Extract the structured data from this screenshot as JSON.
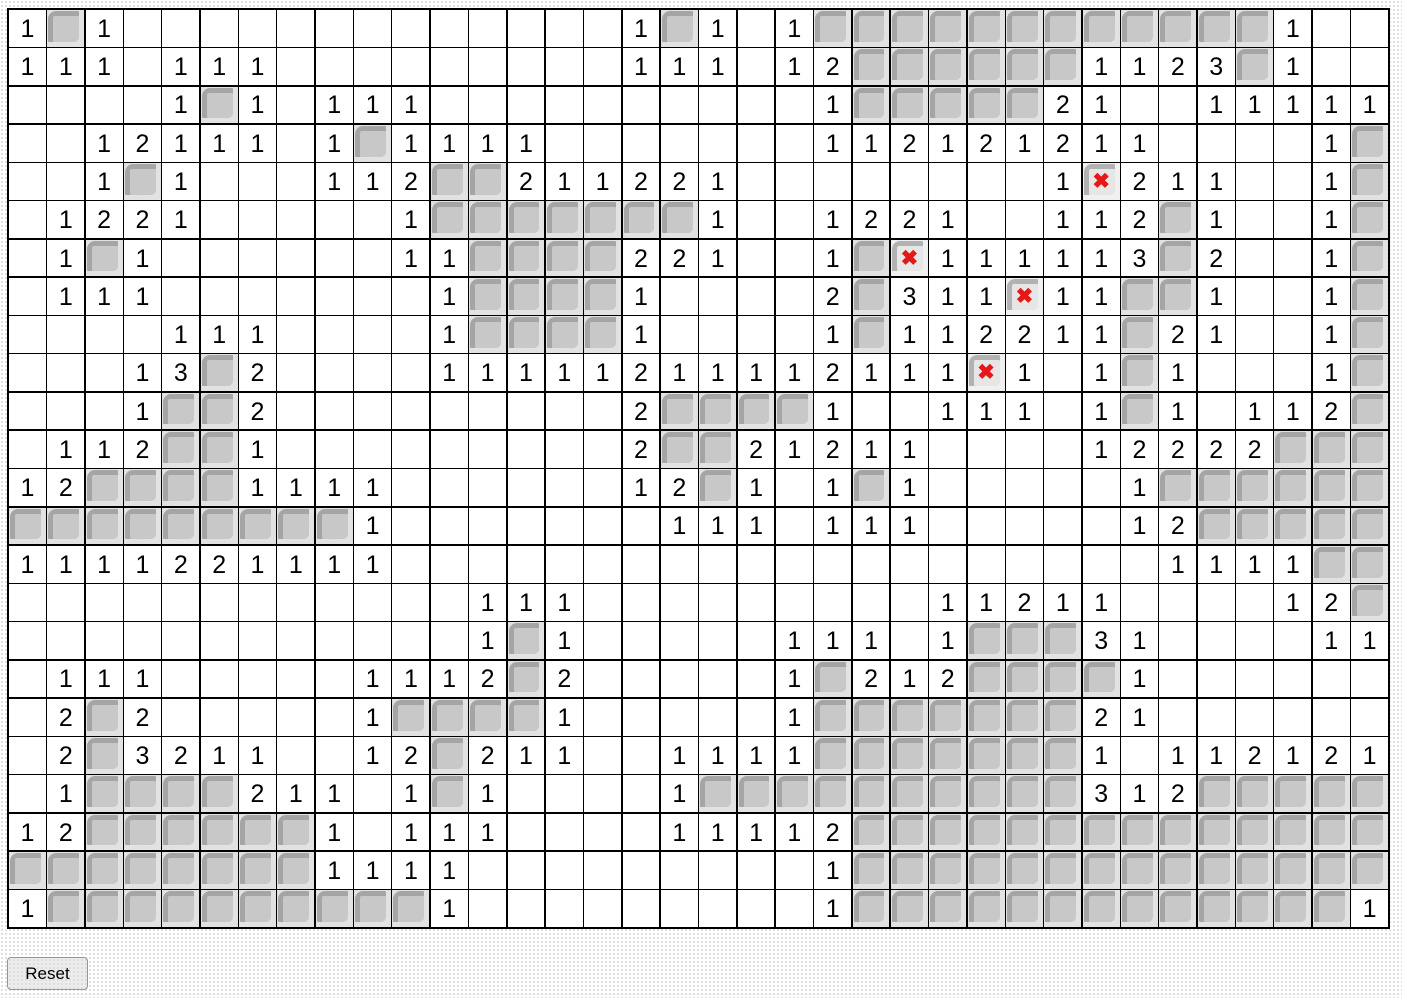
{
  "board": {
    "rows": 24,
    "cols": 36,
    "legend": {
      ".": "revealed empty cell",
      "1": "revealed cell showing 1",
      "2": "revealed cell showing 2",
      "3": "revealed cell showing 3",
      "U": "covered tile (unrevealed)",
      "X": "covered tile flagged with red X"
    },
    "flag_count": 4,
    "grid": [
      "1U1.............1U1.1UUUUUUUUUUUU1..",
      "111.111.........111.12UUUUUU1123U1..",
      "....1U1.111..........1UUUUU21..11111",
      "..12111.1U1111.......112121211....1U",
      "..1U1...112UU211221........1X211..1U",
      ".1221.....1UUUUUUU1..1221..112U1..1U",
      ".1U1......11UUUU221..1UX111113U2..1U",
      ".111.......1UUUU1....2U311X11UU1..1U",
      "....111....1UUUU1....1U112211U21..1U",
      "...13U2....11111211112111X1.1U1...1U",
      "...1UU2.........2UUUU1..111.1U1.112U",
      ".112UU1.........2UU21211....12222UUU",
      "12UUUU1111......12U1.1U1.....1UUUUUU",
      "UUUUUUUUU1.......111.111.....12UUUUU",
      "1111221111....................1111UU",
      "............111.........11211....12U",
      "............1U1.....111.1UUU31....11",
      ".111.....1112U2.....1U212UUUU1......",
      ".2U2.....1UUUU1.....1UUUUUUU21......",
      ".2U3211..12U211..1111UUUUUUU1.112121",
      ".1UUUU211.1U1....1UUUUUUUUUU312UUUUU",
      "12UUUUUU1.111....11112UUUUUUUUUUUUUU",
      "UUUUUUUU1111.........1UUUUUUUUUUUUUU",
      "1UUUUUUUUUU1.........1UUUUUUUUUUUUU1"
    ]
  },
  "icons": {
    "flag_x": "✖"
  },
  "colors": {
    "grid_line": "#000000",
    "cell_bg": "#ffffff",
    "number": "#000000",
    "tile_mid": "#c8c8c8",
    "tile_dark": "#a5a5a5",
    "tile_light": "#e2e2e2",
    "flag_tile_bg": "#f0f0f0",
    "flag_tile_dark": "#b2b2b2",
    "flag_tile_mid": "#e6e6e6",
    "flag_x": "#e51717",
    "page_dot": "#d9d9d9",
    "button_bg": "#ececec",
    "button_border": "#979797"
  },
  "controls": {
    "reset_label": "Reset"
  }
}
